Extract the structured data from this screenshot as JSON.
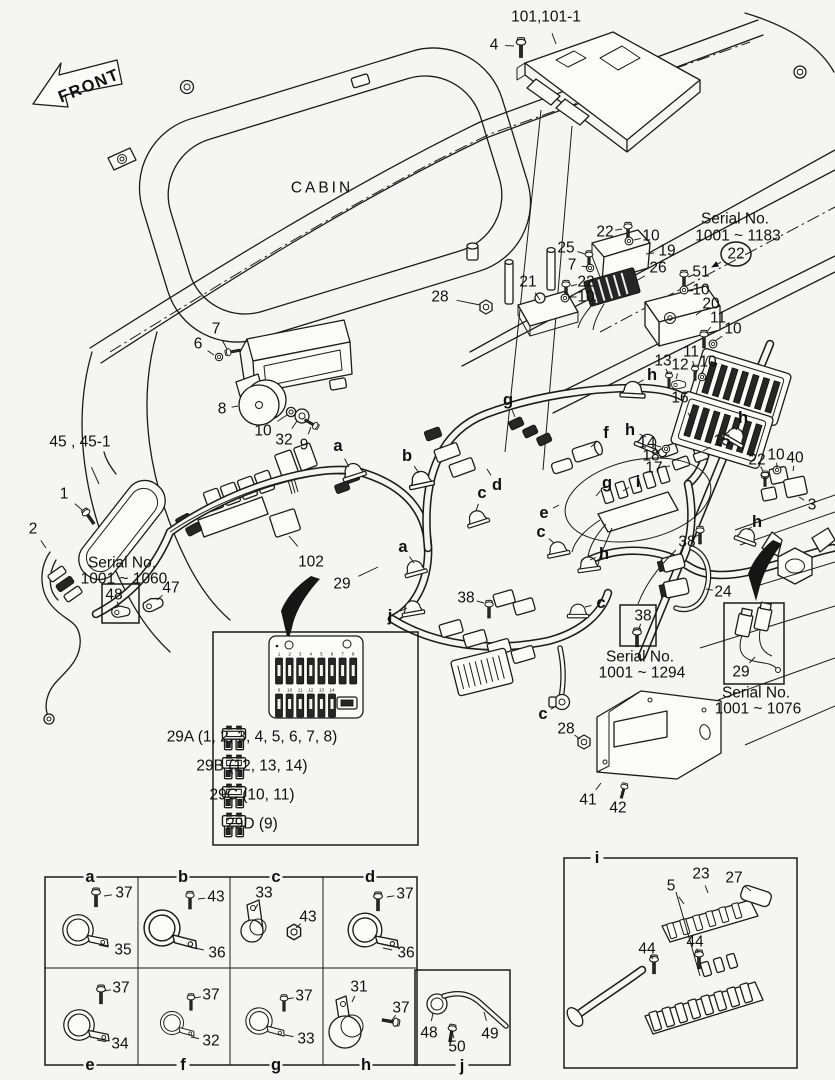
{
  "meta": {
    "bg": "#f5f5f3",
    "ink": "#1b1b1b",
    "width": 835,
    "height": 1080
  },
  "cabin": {
    "label": "CABIN"
  },
  "front_arrow": {
    "label": "FRONT"
  },
  "fuse_inset": {
    "panel_top_numbers": [
      "1",
      "2",
      "3",
      "4",
      "5",
      "6",
      "7",
      "8"
    ],
    "panel_bottom_numbers": [
      "9",
      "10",
      "11",
      "12",
      "13",
      "14"
    ],
    "legend": [
      {
        "code": "29A",
        "circuits": "(1, 2, 3, 4, 5, 6, 7, 8)",
        "y": 737
      },
      {
        "code": "29B",
        "circuits": "(12, 13, 14)",
        "y": 766
      },
      {
        "code": "29C",
        "circuits": "(10, 11)",
        "y": 795
      },
      {
        "code": "29D",
        "circuits": "(9)",
        "y": 824
      }
    ]
  },
  "callouts": [
    {
      "id": "front-label",
      "t": "FRONT",
      "x": 89,
      "y": 86,
      "s": 15,
      "b": 1,
      "r": -22,
      "ls": 1.5
    },
    {
      "id": "cabin-label",
      "t": "CABIN",
      "x": 322,
      "y": 188,
      "s": 15,
      "ls": 3
    },
    {
      "id": "p101",
      "t": "101,101-1",
      "x": 546,
      "y": 17,
      "lx": 556,
      "ly": 44
    },
    {
      "id": "p4",
      "t": "4",
      "x": 494,
      "y": 45,
      "lx": 514,
      "ly": 46
    },
    {
      "id": "sn1183-1",
      "t": "Serial No.",
      "x": 735,
      "y": 219,
      "s": 13.5
    },
    {
      "id": "sn1183-2",
      "t": "1001 ~ 1183",
      "x": 738,
      "y": 236,
      "s": 13.5
    },
    {
      "id": "p22-circled",
      "t": "22",
      "x": 736,
      "y": 254,
      "c": 1,
      "ar": 1,
      "lx": 712,
      "ly": 267
    },
    {
      "id": "p25",
      "t": "25",
      "x": 566,
      "y": 248,
      "lx": 585,
      "ly": 254
    },
    {
      "id": "p22a",
      "t": "22",
      "x": 605,
      "y": 232,
      "lx": 622,
      "ly": 229
    },
    {
      "id": "p10a",
      "t": "10",
      "x": 651,
      "y": 236,
      "lx": 634,
      "ly": 240
    },
    {
      "id": "p19",
      "t": "19",
      "x": 667,
      "y": 251,
      "lx": 646,
      "ly": 254
    },
    {
      "id": "p7a",
      "t": "7",
      "x": 572,
      "y": 265,
      "lx": 588,
      "ly": 267
    },
    {
      "id": "p26",
      "t": "26",
      "x": 658,
      "y": 268,
      "lx": 636,
      "ly": 281
    },
    {
      "id": "p51",
      "t": "51",
      "x": 701,
      "y": 272,
      "lx": 688,
      "ly": 277
    },
    {
      "id": "p10b",
      "t": "10",
      "x": 701,
      "y": 290,
      "lx": 688,
      "ly": 291
    },
    {
      "id": "p21",
      "t": "21",
      "x": 528,
      "y": 282,
      "lx": 540,
      "ly": 300
    },
    {
      "id": "p22b",
      "t": "22",
      "x": 586,
      "y": 282,
      "lx": 571,
      "ly": 286
    },
    {
      "id": "p10c",
      "t": "10",
      "x": 586,
      "y": 297,
      "lx": 570,
      "ly": 297
    },
    {
      "id": "p28a",
      "t": "28",
      "x": 440,
      "y": 297,
      "lx": 480,
      "ly": 305
    },
    {
      "id": "p20",
      "t": "20",
      "x": 711,
      "y": 304,
      "lx": 696,
      "ly": 315
    },
    {
      "id": "p11a",
      "t": "11",
      "x": 718,
      "y": 318,
      "lx": 706,
      "ly": 333
    },
    {
      "id": "p10d",
      "t": "10",
      "x": 733,
      "y": 329,
      "lx": 715,
      "ly": 341
    },
    {
      "id": "p13",
      "t": "13",
      "x": 663,
      "y": 361,
      "lx": 668,
      "ly": 374
    },
    {
      "id": "p12",
      "t": "12",
      "x": 680,
      "y": 365,
      "lx": 676,
      "ly": 379
    },
    {
      "id": "p11b",
      "t": "11",
      "x": 691,
      "y": 352,
      "lx": 694,
      "ly": 367
    },
    {
      "id": "p10e",
      "t": "10",
      "x": 708,
      "y": 362,
      "lx": 701,
      "ly": 374
    },
    {
      "id": "p16",
      "t": "16",
      "x": 680,
      "y": 398,
      "lx": 694,
      "ly": 424
    },
    {
      "id": "h1",
      "t": "h",
      "x": 652,
      "y": 375,
      "b": 1,
      "lx": 638,
      "ly": 383
    },
    {
      "id": "h2",
      "t": "h",
      "x": 630,
      "y": 430,
      "b": 1,
      "lx": 646,
      "ly": 437
    },
    {
      "id": "p14",
      "t": "14",
      "x": 647,
      "y": 443,
      "lx": 661,
      "ly": 447
    },
    {
      "id": "p18",
      "t": "18",
      "x": 651,
      "y": 456,
      "lx": 666,
      "ly": 458
    },
    {
      "id": "p17",
      "t": "17",
      "x": 654,
      "y": 468,
      "lx": 670,
      "ly": 466
    },
    {
      "id": "p15",
      "t": "15",
      "x": 722,
      "y": 441,
      "lx": 703,
      "ly": 451
    },
    {
      "id": "h3",
      "t": "h",
      "x": 743,
      "y": 418,
      "b": 1,
      "lx": 736,
      "ly": 430
    },
    {
      "id": "p22c",
      "t": "22",
      "x": 757,
      "y": 460,
      "lx": 763,
      "ly": 471
    },
    {
      "id": "p10f",
      "t": "10",
      "x": 776,
      "y": 455,
      "lx": 777,
      "ly": 468
    },
    {
      "id": "p40",
      "t": "40",
      "x": 795,
      "y": 458,
      "lx": 793,
      "ly": 471
    },
    {
      "id": "p3",
      "t": "3",
      "x": 812,
      "y": 505,
      "lx": 799,
      "ly": 497
    },
    {
      "id": "h4",
      "t": "h",
      "x": 757,
      "y": 522,
      "b": 1,
      "lx": 748,
      "ly": 530
    },
    {
      "id": "i-main",
      "t": "i",
      "x": 638,
      "y": 482,
      "b": 1,
      "lx": 623,
      "ly": 491
    },
    {
      "id": "g1",
      "t": "g",
      "x": 607,
      "y": 483,
      "b": 1,
      "lx": 596,
      "ly": 496
    },
    {
      "id": "f1",
      "t": "f",
      "x": 606,
      "y": 433,
      "b": 1,
      "lx": 591,
      "ly": 447
    },
    {
      "id": "p38a",
      "t": "38",
      "x": 687,
      "y": 542,
      "lx": 698,
      "ly": 535
    },
    {
      "id": "g2",
      "t": "g",
      "x": 508,
      "y": 400,
      "b": 1,
      "lx": 515,
      "ly": 417
    },
    {
      "id": "d1",
      "t": "d",
      "x": 497,
      "y": 485,
      "b": 1,
      "lx": 487,
      "ly": 469
    },
    {
      "id": "c1",
      "t": "c",
      "x": 482,
      "y": 493,
      "b": 1,
      "lx": 476,
      "ly": 511
    },
    {
      "id": "e1",
      "t": "e",
      "x": 544,
      "y": 513,
      "b": 1,
      "lx": 559,
      "ly": 505
    },
    {
      "id": "c2",
      "t": "c",
      "x": 541,
      "y": 532,
      "b": 1,
      "lx": 554,
      "ly": 543
    },
    {
      "id": "a1",
      "t": "a",
      "x": 338,
      "y": 446,
      "b": 1,
      "lx": 349,
      "ly": 467
    },
    {
      "id": "b1",
      "t": "b",
      "x": 407,
      "y": 456,
      "b": 1,
      "lx": 419,
      "ly": 473
    },
    {
      "id": "a2",
      "t": "a",
      "x": 403,
      "y": 547,
      "b": 1,
      "lx": 414,
      "ly": 563
    },
    {
      "id": "p29a",
      "t": "29",
      "x": 342,
      "y": 584,
      "lx": 378,
      "ly": 567
    },
    {
      "id": "j1",
      "t": "j",
      "x": 390,
      "y": 616,
      "b": 1,
      "lx": 407,
      "ly": 608
    },
    {
      "id": "p38b",
      "t": "38",
      "x": 466,
      "y": 598,
      "lx": 484,
      "ly": 603
    },
    {
      "id": "c3",
      "t": "c",
      "x": 601,
      "y": 603,
      "b": 1,
      "lx": 585,
      "ly": 607
    },
    {
      "id": "h5",
      "t": "h",
      "x": 604,
      "y": 554,
      "b": 1,
      "lx": 590,
      "ly": 560
    },
    {
      "id": "p24",
      "t": "24",
      "x": 723,
      "y": 592,
      "lx": 706,
      "ly": 589
    },
    {
      "id": "p38-boxed",
      "t": "38",
      "x": 643,
      "y": 616,
      "lx": 639,
      "ly": 629
    },
    {
      "id": "sn1294-1",
      "t": "Serial No.",
      "x": 640,
      "y": 657,
      "s": 13.5
    },
    {
      "id": "sn1294-2",
      "t": "1001 ~ 1294",
      "x": 642,
      "y": 673,
      "s": 13.5
    },
    {
      "id": "p29-boxed",
      "t": "29",
      "x": 741,
      "y": 672,
      "lx": 755,
      "ly": 657
    },
    {
      "id": "sn1076-1",
      "t": "Serial No.",
      "x": 756,
      "y": 693,
      "s": 13.5
    },
    {
      "id": "sn1076-2",
      "t": "1001 ~ 1076",
      "x": 758,
      "y": 709,
      "s": 13.5
    },
    {
      "id": "c4",
      "t": "c",
      "x": 543,
      "y": 714,
      "b": 1,
      "lx": 556,
      "ly": 706
    },
    {
      "id": "p28b",
      "t": "28",
      "x": 566,
      "y": 729,
      "lx": 580,
      "ly": 739
    },
    {
      "id": "p41",
      "t": "41",
      "x": 588,
      "y": 800,
      "lx": 601,
      "ly": 783
    },
    {
      "id": "p42",
      "t": "42",
      "x": 618,
      "y": 808,
      "lx": 623,
      "ly": 791
    },
    {
      "id": "p7b",
      "t": "7",
      "x": 216,
      "y": 329,
      "lx": 227,
      "ly": 349
    },
    {
      "id": "p6",
      "t": "6",
      "x": 198,
      "y": 344,
      "lx": 214,
      "ly": 355
    },
    {
      "id": "p8",
      "t": "8",
      "x": 222,
      "y": 409,
      "lx": 238,
      "ly": 406
    },
    {
      "id": "p10g",
      "t": "10",
      "x": 263,
      "y": 431,
      "lx": 287,
      "ly": 415
    },
    {
      "id": "p32",
      "t": "32",
      "x": 284,
      "y": 440,
      "lx": 297,
      "ly": 421
    },
    {
      "id": "p9",
      "t": "9",
      "x": 304,
      "y": 445,
      "lx": 311,
      "ly": 427
    },
    {
      "id": "p45",
      "t": "45 , 45-1",
      "x": 80,
      "y": 442,
      "lx": 99,
      "ly": 484
    },
    {
      "id": "p1",
      "t": "1",
      "x": 64,
      "y": 494,
      "lx": 82,
      "ly": 510
    },
    {
      "id": "p2",
      "t": "2",
      "x": 33,
      "y": 529,
      "lx": 46,
      "ly": 548
    },
    {
      "id": "sn1060-1",
      "t": "Serial No.",
      "x": 122,
      "y": 563,
      "s": 13.5
    },
    {
      "id": "sn1060-2",
      "t": "1001 ~ 1060",
      "x": 124,
      "y": 579,
      "s": 13.5
    },
    {
      "id": "p48-boxed",
      "t": "48",
      "x": 114,
      "y": 595,
      "lx": 119,
      "ly": 606
    },
    {
      "id": "p47",
      "t": "47",
      "x": 171,
      "y": 588,
      "lx": 157,
      "ly": 600
    },
    {
      "id": "p102",
      "t": "102",
      "x": 311,
      "y": 562,
      "lx": 289,
      "ly": 536
    },
    {
      "id": "tbl-a",
      "t": "a",
      "x": 90,
      "y": 877,
      "b": 1,
      "bg": 1
    },
    {
      "id": "tbl-b",
      "t": "b",
      "x": 183,
      "y": 877,
      "b": 1,
      "bg": 1
    },
    {
      "id": "tbl-c",
      "t": "c",
      "x": 276,
      "y": 877,
      "b": 1,
      "bg": 1
    },
    {
      "id": "tbl-d",
      "t": "d",
      "x": 370,
      "y": 877,
      "b": 1,
      "bg": 1
    },
    {
      "id": "tbl-e",
      "t": "e",
      "x": 90,
      "y": 1065,
      "b": 1,
      "bg": 1
    },
    {
      "id": "tbl-f",
      "t": "f",
      "x": 183,
      "y": 1065,
      "b": 1,
      "bg": 1
    },
    {
      "id": "tbl-g",
      "t": "g",
      "x": 276,
      "y": 1065,
      "b": 1,
      "bg": 1
    },
    {
      "id": "tbl-h",
      "t": "h",
      "x": 366,
      "y": 1065,
      "b": 1,
      "bg": 1
    },
    {
      "id": "tbl-j",
      "t": "j",
      "x": 462,
      "y": 1066,
      "b": 1,
      "bg": 1
    },
    {
      "id": "ca-37",
      "t": "37",
      "x": 124,
      "y": 893,
      "lx": 104,
      "ly": 896
    },
    {
      "id": "ca-35",
      "t": "35",
      "x": 123,
      "y": 950,
      "lx": 99,
      "ly": 945
    },
    {
      "id": "cb-43",
      "t": "43",
      "x": 216,
      "y": 897,
      "lx": 198,
      "ly": 899
    },
    {
      "id": "cb-36",
      "t": "36",
      "x": 217,
      "y": 953,
      "lx": 195,
      "ly": 948
    },
    {
      "id": "cc-33",
      "t": "33",
      "x": 264,
      "y": 893,
      "lx": 254,
      "ly": 911
    },
    {
      "id": "cc-43",
      "t": "43",
      "x": 308,
      "y": 917,
      "lx": 296,
      "ly": 928
    },
    {
      "id": "cd-37",
      "t": "37",
      "x": 405,
      "y": 894,
      "lx": 387,
      "ly": 897
    },
    {
      "id": "cd-36",
      "t": "36",
      "x": 406,
      "y": 953,
      "lx": 383,
      "ly": 948
    },
    {
      "id": "ce-37",
      "t": "37",
      "x": 121,
      "y": 988,
      "lx": 104,
      "ly": 991
    },
    {
      "id": "ce-34",
      "t": "34",
      "x": 120,
      "y": 1044,
      "lx": 97,
      "ly": 1040
    },
    {
      "id": "cf-37",
      "t": "37",
      "x": 211,
      "y": 995,
      "lx": 194,
      "ly": 998
    },
    {
      "id": "cf-32",
      "t": "32",
      "x": 211,
      "y": 1041,
      "lx": 191,
      "ly": 1037
    },
    {
      "id": "cg-37",
      "t": "37",
      "x": 304,
      "y": 996,
      "lx": 287,
      "ly": 999
    },
    {
      "id": "cg-33",
      "t": "33",
      "x": 306,
      "y": 1039,
      "lx": 285,
      "ly": 1035
    },
    {
      "id": "ch-31",
      "t": "31",
      "x": 359,
      "y": 987,
      "lx": 352,
      "ly": 1002
    },
    {
      "id": "ch-37",
      "t": "37",
      "x": 401,
      "y": 1008,
      "lx": 392,
      "ly": 1020
    },
    {
      "id": "cj-48",
      "t": "48",
      "x": 429,
      "y": 1033,
      "lx": 433,
      "ly": 1013
    },
    {
      "id": "cj-50",
      "t": "50",
      "x": 457,
      "y": 1047,
      "lx": 452,
      "ly": 1032
    },
    {
      "id": "cj-49",
      "t": "49",
      "x": 490,
      "y": 1034,
      "lx": 484,
      "ly": 1012
    },
    {
      "id": "inset-i-label",
      "t": "i",
      "x": 597,
      "y": 858,
      "b": 1,
      "bg": 1
    },
    {
      "id": "i-23",
      "t": "23",
      "x": 701,
      "y": 874,
      "lx": 708,
      "ly": 893
    },
    {
      "id": "i-27",
      "t": "27",
      "x": 734,
      "y": 878,
      "lx": 751,
      "ly": 891
    },
    {
      "id": "i-5",
      "t": "5",
      "x": 671,
      "y": 886,
      "lx": 684,
      "ly": 904
    },
    {
      "id": "i-44a",
      "t": "44",
      "x": 647,
      "y": 949,
      "lx": 653,
      "ly": 959
    },
    {
      "id": "i-44b",
      "t": "44",
      "x": 695,
      "y": 942,
      "lx": 698,
      "ly": 953
    }
  ]
}
